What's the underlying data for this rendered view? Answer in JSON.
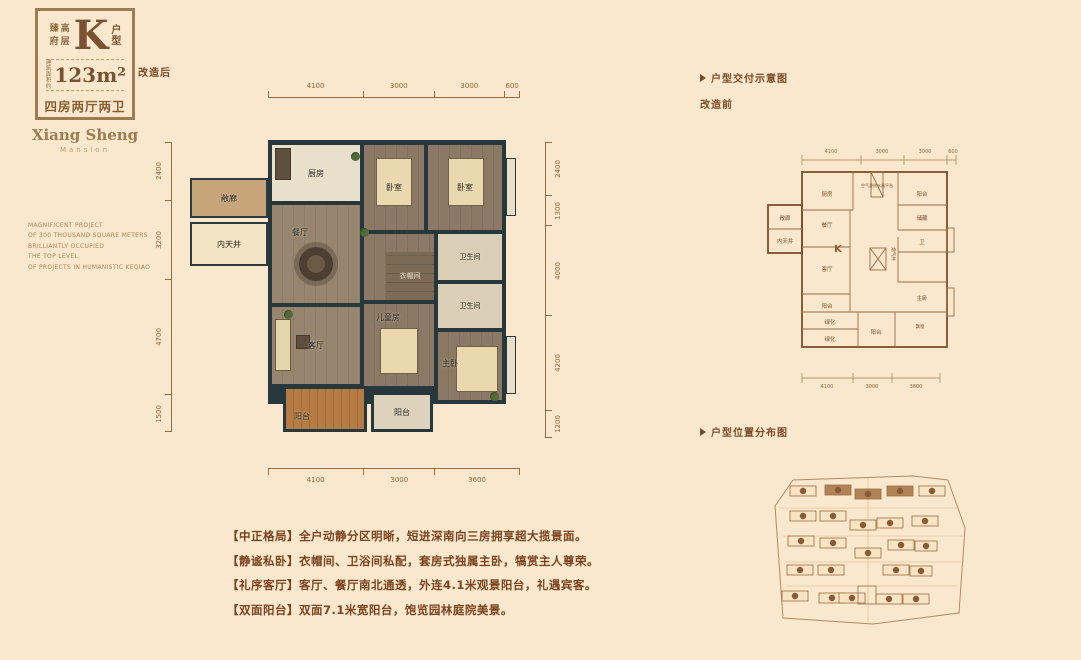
{
  "colors": {
    "background": "#f9e8cd",
    "brown": "#7b4a26",
    "wall_dark": "#27383d",
    "balcony_orange": "#b67b42"
  },
  "badge": {
    "series": "臻府高层",
    "unit_letter": "K",
    "unit_suffix": "户型",
    "area_label_line1": "建筑",
    "area_label_line2": "面积约",
    "area_value": "123m²",
    "rooms_summary": "四房两厅两卫"
  },
  "brand": {
    "name": "Xiang Sheng",
    "subtitle": "Mansion"
  },
  "slogan": {
    "line1": "MAGNIFICENT PROJECT",
    "line2": "OF 300 THOUSAND SQUARE METERS",
    "line3": "BRILLIANTLY OCCUPIED",
    "line4": "THE TOP LEVEL",
    "line5": "OF PROJECTS IN HUMANISTIC KEQIAO"
  },
  "main_plan": {
    "stage_label": "改造后",
    "dims_top": [
      "4100",
      "3000",
      "3000",
      "600"
    ],
    "dims_bottom": [
      "4100",
      "3000",
      "3600"
    ],
    "dims_left": [
      "2400",
      "3200",
      "4700",
      "1500"
    ],
    "dims_right": [
      "2400",
      "1300",
      "4000",
      "4200",
      "1200"
    ],
    "rooms": {
      "kitchen": "厨房",
      "dining": "餐厅",
      "living": "客厅",
      "bedroom_a": "卧室",
      "bedroom_b": "卧室",
      "bath_a": "卫生间",
      "bath_b": "卫生间",
      "cloakroom": "衣帽间",
      "kids_room": "儿童房",
      "master": "主卧",
      "balcony_main": "阳台",
      "balcony_small": "阳台",
      "gallery": "敞廊",
      "courtyard": "内天井"
    }
  },
  "delivery": {
    "title": "户型交付示意图",
    "stage_label": "改造前",
    "unit_mark": "K",
    "dims_top": [
      "4100",
      "3000",
      "3000",
      "600"
    ],
    "dims_bottom": [
      "4100",
      "3000",
      "3600"
    ],
    "rooms": {
      "kitchen": "厨房",
      "dining": "餐厅",
      "living": "客厅",
      "master": "主卧",
      "bath": "卫",
      "storage": "储藏",
      "heater_platform": "空气源热水器平台",
      "vent_shaft": "烟气井",
      "balcony_north": "阳台",
      "balcony_west": "阳台",
      "balcony_south": "阳台",
      "green_a": "绿化",
      "green_b": "绿化",
      "bay_window": "飘窗",
      "gallery": "敞廊",
      "courtyard": "内天井"
    }
  },
  "location": {
    "title": "户型位置分布图"
  },
  "features": [
    {
      "tag": "【中正格局】",
      "text": "全户动静分区明晰，短进深南向三房拥享超大揽景面。"
    },
    {
      "tag": "【静谧私卧】",
      "text": "衣帽间、卫浴间私配，套房式独属主卧，犒赏主人尊荣。"
    },
    {
      "tag": "【礼序客厅】",
      "text": "客厅、餐厅南北通透，外连4.1米观景阳台，礼遇宾客。"
    },
    {
      "tag": "【双面阳台】",
      "text": "双面7.1米宽阳台，饱览园林庭院美景。"
    }
  ]
}
